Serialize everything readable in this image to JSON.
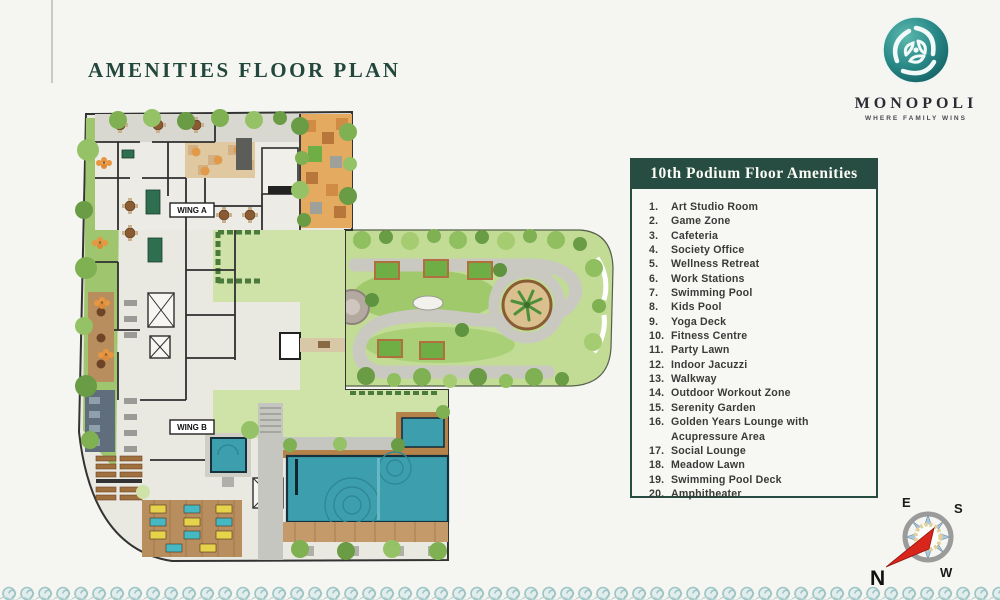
{
  "page": {
    "title": "AMENITIES FLOOR PLAN"
  },
  "logo": {
    "name": "MONOPOLI",
    "tagline": "WHERE FAMILY WINS"
  },
  "amenities": {
    "header": "10th Podium Floor Amenities",
    "items": [
      {
        "num": "1.",
        "label": "Art Studio Room"
      },
      {
        "num": "2.",
        "label": "Game Zone"
      },
      {
        "num": "3.",
        "label": "Cafeteria"
      },
      {
        "num": "4.",
        "label": "Society Office"
      },
      {
        "num": "5.",
        "label": "Wellness Retreat"
      },
      {
        "num": "6.",
        "label": "Work Stations"
      },
      {
        "num": "7.",
        "label": "Swimming Pool"
      },
      {
        "num": "8.",
        "label": "Kids Pool"
      },
      {
        "num": "9.",
        "label": "Yoga Deck"
      },
      {
        "num": "10.",
        "label": "Fitness Centre"
      },
      {
        "num": "11.",
        "label": "Party Lawn"
      },
      {
        "num": "12.",
        "label": "Indoor Jacuzzi"
      },
      {
        "num": "13.",
        "label": "Walkway"
      },
      {
        "num": "14.",
        "label": "Outdoor Workout Zone"
      },
      {
        "num": "15.",
        "label": "Serenity Garden"
      },
      {
        "num": "16.",
        "label": "Golden Years Lounge with Acupressure Area"
      },
      {
        "num": "17.",
        "label": "Social Lounge"
      },
      {
        "num": "18.",
        "label": "Meadow Lawn"
      },
      {
        "num": "19.",
        "label": "Swimming Pool Deck"
      },
      {
        "num": "20.",
        "label": "Amphitheater"
      }
    ]
  },
  "floor_plan": {
    "wing_a": "WING A",
    "wing_b": "WING B"
  },
  "compass": {
    "n": "N",
    "e": "E",
    "s": "S",
    "w": "W"
  },
  "colors": {
    "brand_green": "#274d42",
    "logo_teal": "#2a8a88",
    "pool_teal": "#3d9fae",
    "lawn_light": "#cfe3a8",
    "garden_green": "#c2dc96",
    "wood_deck": "#b98e5f",
    "walkway_gray": "#c6c6c0",
    "compass_needle_red": "#d8261c",
    "wave_border_teal": "#9fc4c4"
  }
}
